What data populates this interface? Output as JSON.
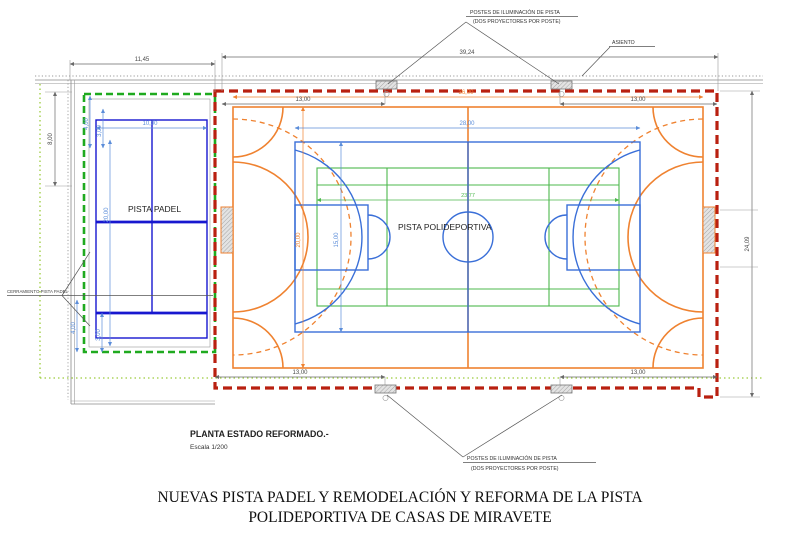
{
  "drawing": {
    "labels": {
      "postes_top": {
        "line1": "POSTES DE ILUMINACIÓN DE PISTA",
        "line2": "(DOS PROYECTORES POR POSTE)"
      },
      "postes_bottom": {
        "line1": "POSTES DE ILUMINACIÓN DE PISTA",
        "line2": "(DOS PROYECTORES POR POSTE)"
      },
      "asiento": "ASIENTO",
      "cerramiento": "CERRAMIENTO PISTA PADEL",
      "pista_padel": "PISTA PADEL",
      "pista_polideportiva": "PISTA POLIDEPORTIVA",
      "planta": "PLANTA ESTADO REFORMADO.-",
      "escala": "Escala 1/200"
    },
    "dimensions": {
      "padel_zone_width": "11,45",
      "total_width": "39,24",
      "left_height": "8,00",
      "right_height": "24,09",
      "top_left_span": "13,00",
      "top_right_span": "13,00",
      "bottom_left_span": "13,00",
      "bottom_right_span": "13,00",
      "orange_court_width": "36,00",
      "orange_court_height": "20,00",
      "basketball_length": "28,00",
      "basketball_width": "15,00",
      "green_court_width": "23,77",
      "padel_width": "10,00",
      "padel_length": "20,00",
      "padel_wall_top_a": "4,00",
      "padel_wall_top_b": "3,00",
      "padel_wall_bottom_a": "4,00",
      "padel_wall_bottom_b": "3,00"
    },
    "colors": {
      "red_boundary": "#b92010",
      "orange_court": "#ef8230",
      "blue_basketball": "#3a6fd8",
      "blue_padel": "#1717cf",
      "blue_dims": "#5b8dd9",
      "green_court": "#4db84d",
      "green_fence_dashed": "#1faa1f",
      "green_property_dotted": "#9ccc3c",
      "dim_gray": "#6a6a6a"
    }
  },
  "title": {
    "line1": "NUEVAS PISTA PADEL Y REMODELACIÓN Y REFORMA DE LA PISTA",
    "line2": "POLIDEPORTIVA DE CASAS DE MIRAVETE"
  }
}
